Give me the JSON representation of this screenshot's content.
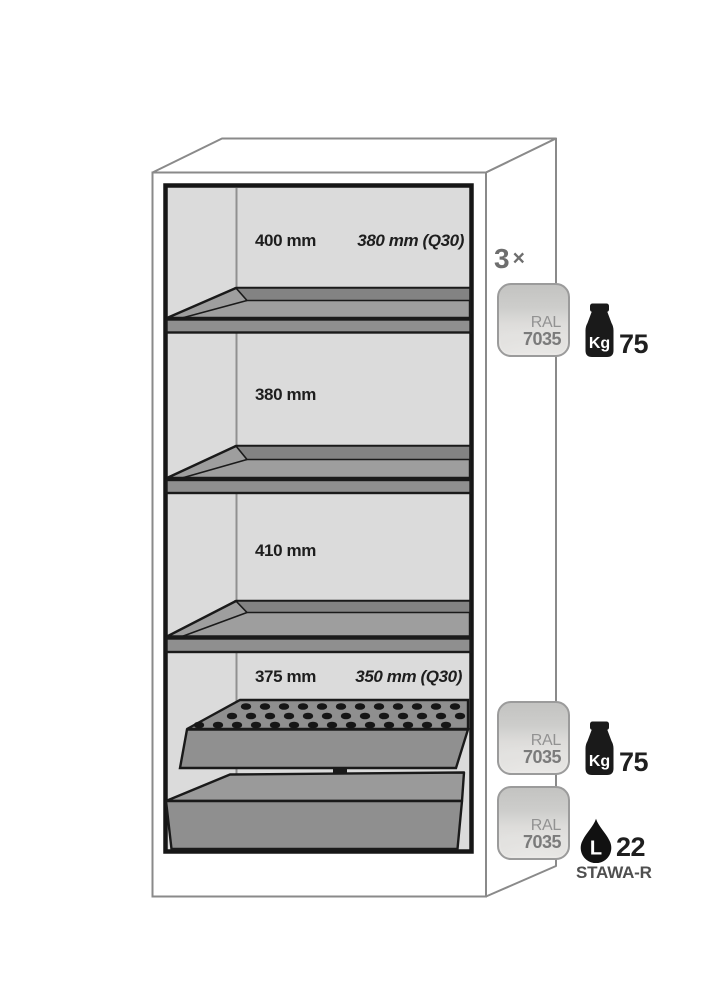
{
  "cabinet": {
    "compartments": [
      {
        "height": "400 mm",
        "depth_q30": "380 mm (Q30)"
      },
      {
        "height": "380 mm"
      },
      {
        "height": "410 mm"
      },
      {
        "height": "375 mm",
        "depth_q30": "350 mm (Q30)"
      }
    ]
  },
  "annotations": {
    "shelf_set": {
      "count": "3",
      "multiplier": "×",
      "ral_name": "RAL",
      "ral_code": "7035",
      "capacity_icon": "weight-kg-icon",
      "capacity_unit": "Kg",
      "capacity_value": "75"
    },
    "perforated_insert": {
      "ral_name": "RAL",
      "ral_code": "7035",
      "capacity_icon": "weight-kg-icon",
      "capacity_unit": "Kg",
      "capacity_value": "75"
    },
    "sump_tray": {
      "ral_name": "RAL",
      "ral_code": "7035",
      "volume_icon": "drop-icon",
      "volume_unit": "L",
      "volume_value": "22",
      "approval": "STAWA-R"
    }
  },
  "colors": {
    "ral_7035_swatch": "#d9d8d6",
    "shelf_gray": "#9e9e9e",
    "interior_gray": "#dbdbdb",
    "outline_black": "#1a1a1a",
    "frame_gray": "#8a8a8a",
    "muted_text_gray": "#6e6e6e"
  }
}
